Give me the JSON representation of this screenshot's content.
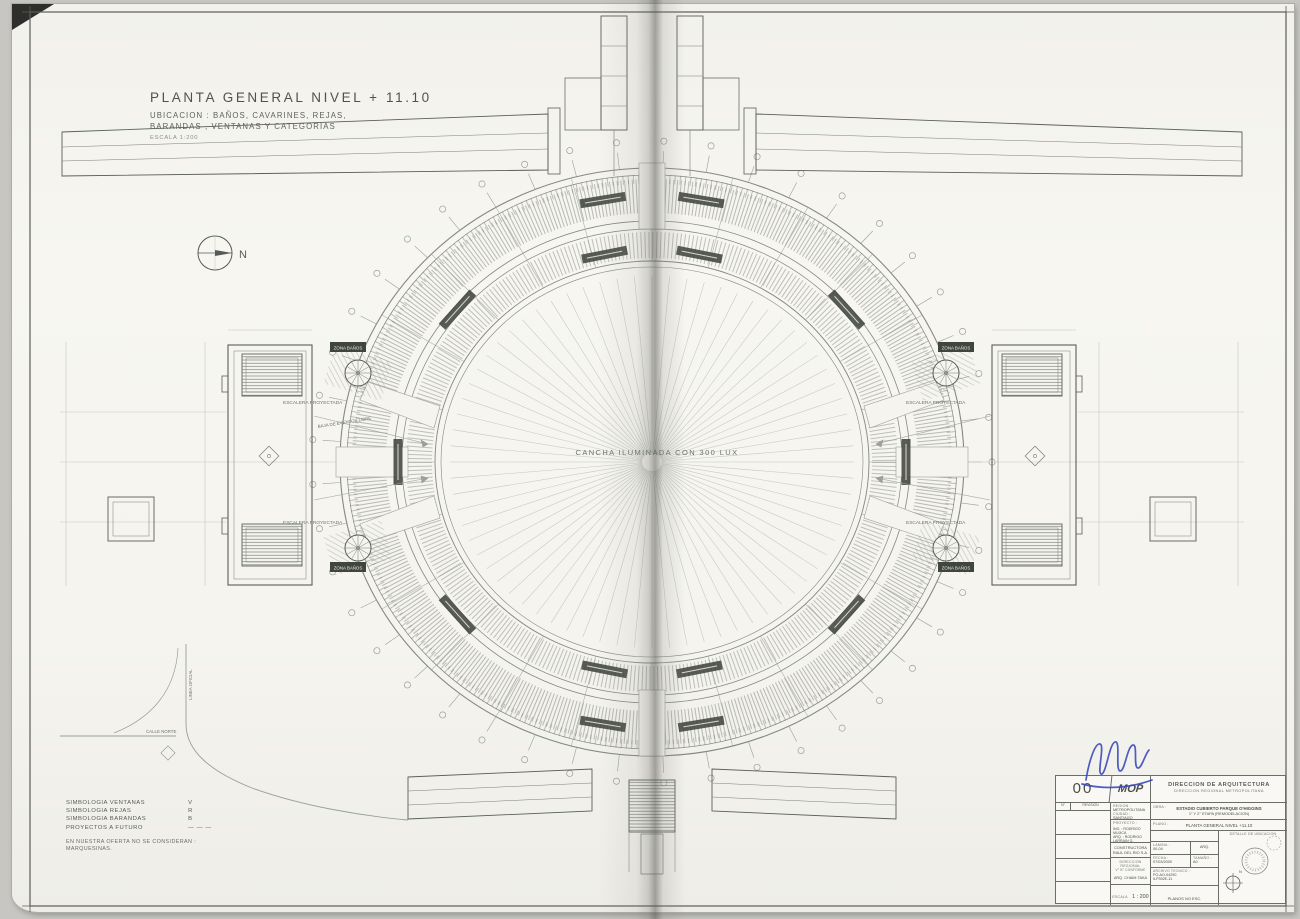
{
  "colors": {
    "paper": "#f5f4ee",
    "ink": "#7a7f78",
    "mid": "#9aa09a",
    "faint": "#c3c8c2",
    "strong": "#5a5f58",
    "dark": "#41453f",
    "signature": "#3647bb"
  },
  "header": {
    "title": "PLANTA GENERAL NIVEL + 11.10",
    "subtitle1": "UBICACION : BAÑOS, CAVARINES, REJAS,",
    "subtitle2": "BARANDAS , VENTANAS Y CATEGORIAS",
    "scale_note": "ESCALA 1:200"
  },
  "north_label": "N",
  "plan": {
    "field_label": "CANCHA ILUMINADA CON 300 LUX",
    "stair_label": "ESCALERA PROYECTADA",
    "zone_label": "ZONA BAÑOS",
    "access_label": "BAJA DE EVENTOS LIBRE",
    "road_label_h": "CALLE NORTE",
    "road_label_v": "LINEA OFICIAL"
  },
  "legend": {
    "rows": [
      {
        "label": "SIMBOLOGIA VENTANAS",
        "sym": "V"
      },
      {
        "label": "SIMBOLOGIA REJAS",
        "sym": "R"
      },
      {
        "label": "SIMBOLOGIA BARANDAS",
        "sym": "B"
      },
      {
        "label": "PROYECTOS A FUTURO",
        "sym": "— — —"
      }
    ],
    "note1": "EN NUESTRA OFERTA NO SE CONSIDERAN :",
    "note2": "MARQUESINAS."
  },
  "title_block": {
    "sheet_no": "00",
    "logo": "MOP",
    "org1": "DIRECCION  DE  ARQUITECTURA",
    "org2": "DIRECCION REGIONAL METROPOLITANA",
    "rev_no": "N°",
    "rev_label": "REVISION",
    "region_label": "REGION :",
    "region": "METROPOLITANA",
    "ciudad_label": "CIUDAD :",
    "ciudad": "SANTIAGO",
    "comuna_label": "COMUNA :",
    "comuna": "SANTIAGO",
    "proyecto_label": "PROYECTO :",
    "ing": "ING. : RODRIGO MUJICA",
    "arq": "ARQ. : RODRIGO LARRAIN G.",
    "constructora1": "CONSTRUCTORA",
    "constructora2": "RAUL DEL RIO S.A.",
    "director1": "DIRECCION REGIONAL",
    "director2": "V° B° CONFORME",
    "director3": "ARQ. CHAIM TAKA",
    "escala_label": "ESCALA",
    "escala": "1 : 200",
    "obra_label": "OBRA :",
    "obra1": "ESTADIO CUBIERTO PARQUE O'HIGGINS",
    "obra2": "1° Y 2° ETAPA (REMODELACION)",
    "plano_label": "PLANO :",
    "plano": "PLANTA GENERAL NIVEL +11.10",
    "dibujo_label": "DIBUJO :",
    "dibujo": "A.C.R.",
    "lamina_label": "LAMINA :",
    "lamina": "00-04",
    "lamina2": "ARQ.",
    "fecha_label": "FECHA :",
    "fecha": "07/03/2000",
    "tamano_label": "TAMAÑO :",
    "tamano": "A0",
    "archivo_label": "ARCHIVO TECNICO :",
    "archivo1": "PO-AO-04290",
    "archivo2": "ILP302E-11",
    "planos": "PLANOS  NO ESC.",
    "detalle": "DETALLE DE UBICACION",
    "detalle_n": "N"
  }
}
